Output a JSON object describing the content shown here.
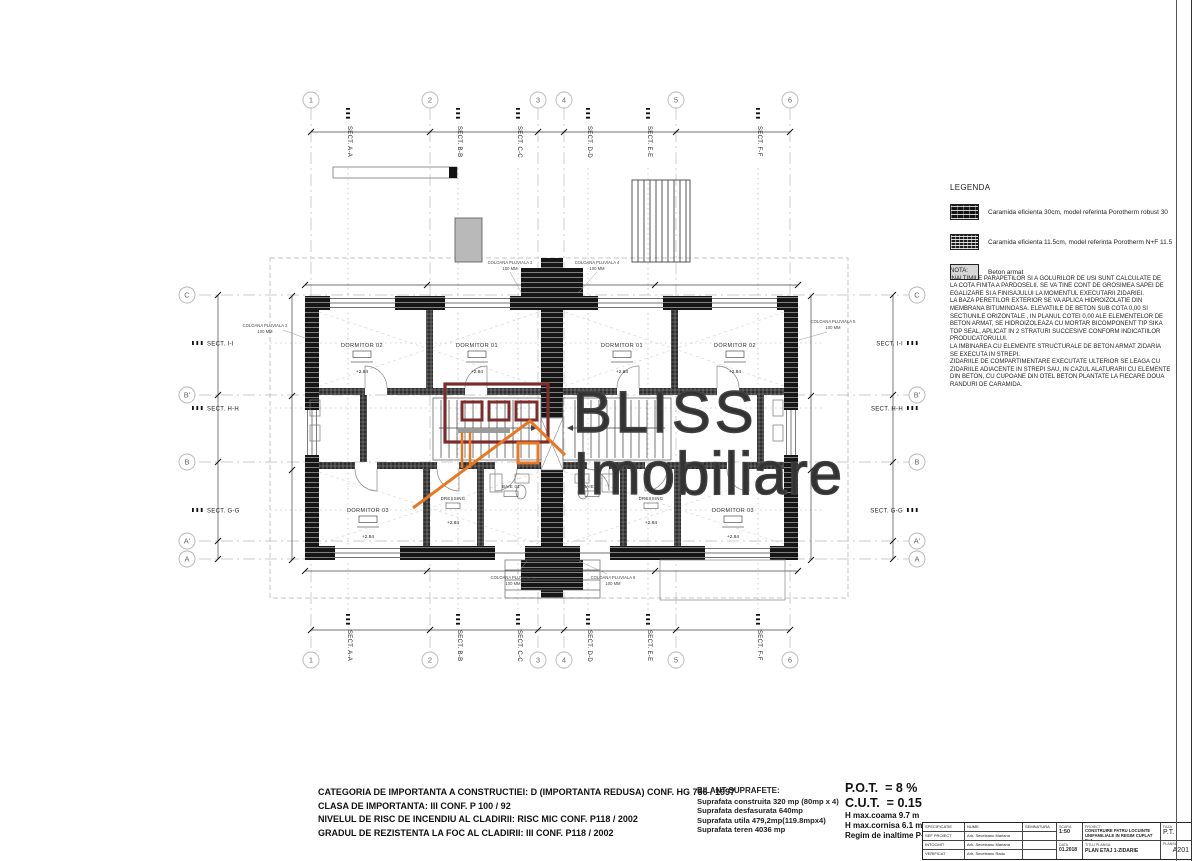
{
  "plan": {
    "watermark": {
      "line1": "BLISS",
      "line2": "Imobiliare"
    },
    "grid_cols": [
      "1",
      "2",
      "3",
      "4",
      "5",
      "6"
    ],
    "grid_rows": [
      "C",
      "B'",
      "B",
      "A'",
      "A"
    ],
    "sections_top": [
      "SECT. A-A",
      "SECT. B-B",
      "SECT. C-C",
      "SECT. D-D",
      "SECT. E-E",
      "SECT. F-F"
    ],
    "sections_side": [
      "SECT. I-I",
      "SECT. H-H",
      "SECT. G-G"
    ],
    "rooms": {
      "left_bed2": "DORMITOR 02",
      "left_bed1": "DORMITOR 01",
      "right_bed1": "DORMITOR 01",
      "right_bed2": "DORMITOR 02",
      "left_bed3": "DORMITOR 03",
      "left_dressing": "DRESSING",
      "left_bath": "BAIE 01",
      "right_bath": "BAIE 02",
      "right_dressing": "DRESSING",
      "right_bed3": "DORMITOR 03",
      "elevation": "+2.84"
    },
    "pluvial": {
      "p1": "COLOANA PLUVIALA 1",
      "p2": "COLOANA PLUVIALA 2",
      "p3": "COLOANA PLUVIALA 3",
      "p4": "COLOANA PLUVIALA 4",
      "p5": "COLOANA PLUVIALA 5",
      "p6": "COLOANA PLUVIALA 6",
      "size": "100 MM"
    }
  },
  "legend": {
    "title": "LEGENDA",
    "items": [
      {
        "label": "Caramida eficienta 30cm, model referinta Porotherm robust 30"
      },
      {
        "label": "Caramida eficienta 11.5cm, model referinta Porotherm N+F 11.5"
      },
      {
        "label": "Beton armat"
      }
    ]
  },
  "nota": {
    "title": "NOTA:",
    "lines": [
      "INALTIMILE PARAPETILOR SI A GOLURILOR DE USI SUNT CALCULATE DE",
      "LA COTA FINITA A PARDOSELII. SE VA TINE CONT DE GROSIMEA SAPEI DE",
      "EGALIZARE SI A FINISAJULUI LA MOMENTUL EXECUTARII ZIDARIEI.",
      "LA BAZA PERETILOR EXTERIOR SE VA APLICA HIDROIZOLATIE DIN",
      "MEMBRANA BITUMINOASA. ELEVATIILE  DE BETON SUB COTA 0,00 SI",
      "SECTIUNILE ORIZONTALE , IN PLANUL COTEI 0,00 ALE ELEMENTELOR DE",
      "BETON ARMAT, SE HIDROIZOLEAZA CU MORTAR BICOMPONENT TIP SIKA",
      "TOP SEAL, APLICAT IN 2 STRATURI  SUCCESIVE CONFORM INDICATIILOR",
      "PRODUCATORULUI.",
      "LA IMBINAREA CU ELEMENTE STRUCTURALE DE BETON ARMAT ZIDARIA",
      "SE EXECUTA IN STREPI.",
      "ZIDARIILE  DE COMPARTIMENTARE EXECUTATE ULTERIOR SE LEAGA CU",
      "ZIDARIILE ADIACENTE IN STREPI SAU, IN CAZUL ALATURARII CU ELEMENTE",
      "DIN BETON, CU CUPOANE DIN OTEL BETON PLANTATE LA FIECARE DOUA",
      "RANDURI DE CARAMIDA."
    ]
  },
  "compliance": {
    "lines": [
      "CATEGORIA DE IMPORTANTA  A  CONSTRUCTIEI: D (IMPORTANTA REDUSA) CONF. HG 766 / 1997",
      "CLASA DE IMPORTANTA: III CONF. P 100 / 92",
      "NIVELUL DE RISC DE INCENDIU AL CLADIRII: RISC MIC CONF. P118 / 2002",
      "GRADUL DE REZISTENTA LA FOC AL CLADIRII: III CONF. P118 / 2002"
    ]
  },
  "areas": {
    "title": "BILANT SUPRAFETE:",
    "lines": [
      "Suprafata construita 320 mp (80mp x 4)",
      "Suprafata desfasurata 640mp",
      "Suprafata utila 479,2mp(119.8mpx4)",
      "Suprafata teren 4036 mp"
    ]
  },
  "indicators": {
    "pot": "P.O.T.  = 8 %",
    "cut": "C.U.T.  = 0.15",
    "lines": [
      "H max.coama 9.7 m",
      "H max.cornisa 6.1 m",
      "Regim de inaltime P+1"
    ]
  },
  "title_block": {
    "col_headers": {
      "spec": "SPECIFICATIE",
      "name": "NUME",
      "signature": "SEMNATURA"
    },
    "rows": [
      {
        "role": "SEF PROIECT",
        "name": "Arh. Seceleanu Mariana"
      },
      {
        "role": "INTOCMIT",
        "name": "Arh. Seceleanu Mariana"
      },
      {
        "role": "VERIFICAT",
        "name": "Arh. Seceleanu Radu"
      }
    ],
    "scale_label": "SCARA",
    "scale": "1:50",
    "date_label": "DATA",
    "date": "01.2018",
    "project_label": "PROIECT:",
    "project_title_1": "CONSTRUIRE PATRU LOCUINTE",
    "project_title_2": "UNIFAMILIALE IN REGIM CUPLAT P+1",
    "sheet_label": "TITLU PLANSA:",
    "sheet_title": "PLAN ETAJ 1-ZIDARIE",
    "phase_label": "FAZA",
    "phase": "P.T.",
    "number_label": "PLANSA",
    "number": "A201"
  },
  "colors": {
    "logo_maroon": "#7d2c2c",
    "logo_orange": "#e87722",
    "watermark_gray": "#424242"
  }
}
